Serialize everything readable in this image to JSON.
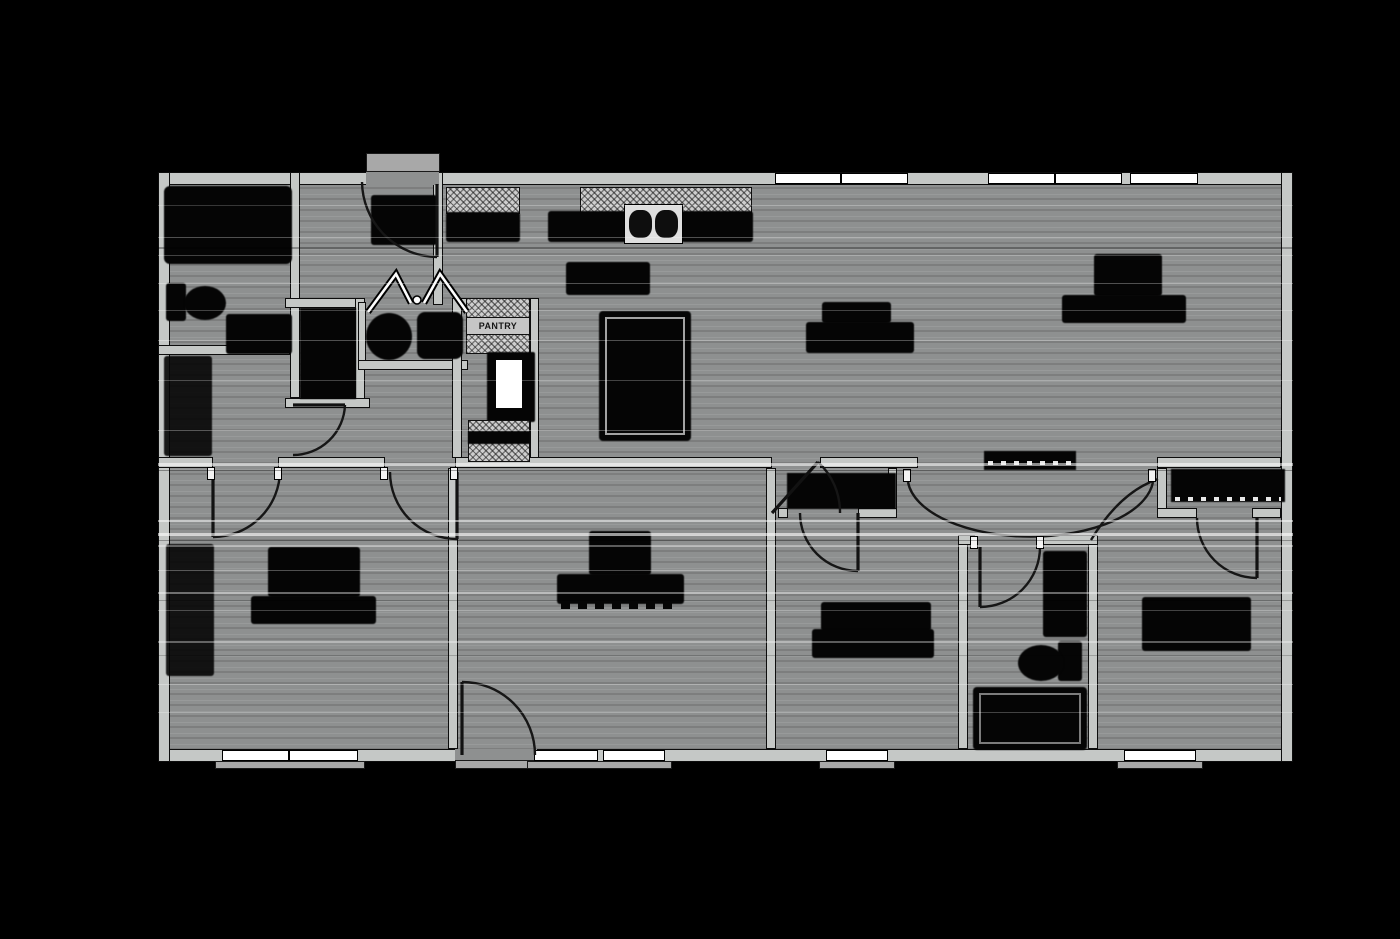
{
  "plan": {
    "pantry_label": "PANTRY",
    "colors": {
      "outside": "#000000",
      "floor": "#8e9090",
      "wall": "#c5c8c6",
      "wall_edge": "#0d0d0d",
      "window": "#ffffff",
      "fixture": "#050505",
      "sill": "#a8a8a8"
    },
    "label_blobs": [
      "kitchen",
      "dining",
      "living-room",
      "master-bedroom",
      "family-room",
      "bedroom-2",
      "bedroom-3"
    ],
    "fixtures": [
      "garden-tub",
      "toilet",
      "vanity",
      "washer",
      "dryer",
      "refrigerator",
      "pantry-shelves",
      "kitchen-sink",
      "kitchen-island",
      "hall-bath-tub",
      "hall-bath-toilet",
      "hall-bath-vanity",
      "closet-shelves"
    ],
    "window_groups": {
      "top": 3,
      "bottom": 4
    },
    "door_count": 11
  }
}
